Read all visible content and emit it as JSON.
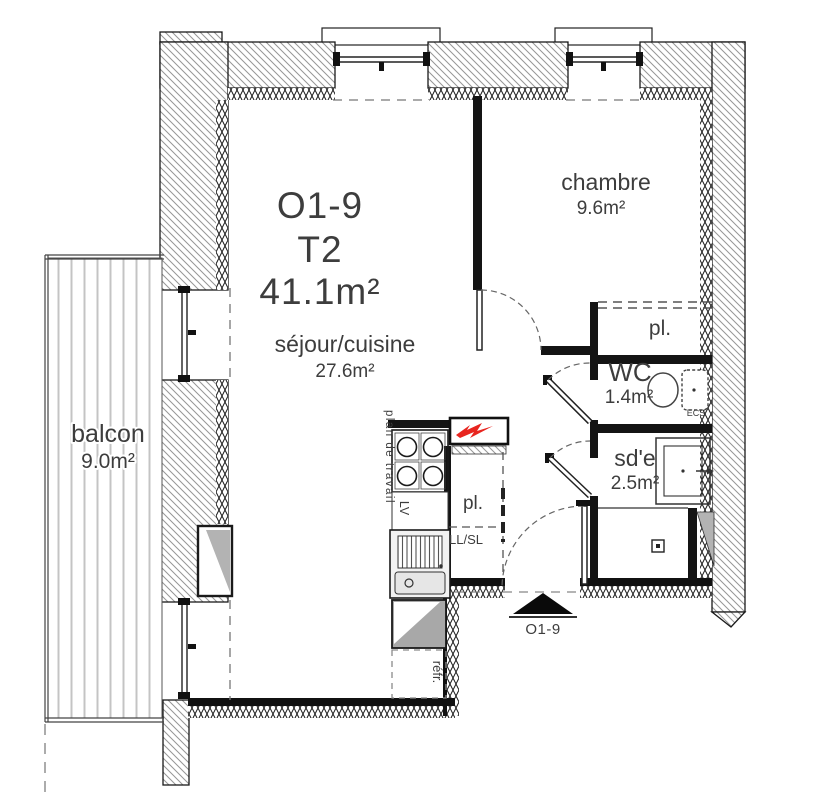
{
  "unit": {
    "id": "O1-9",
    "type": "T2",
    "area": "41.1m²"
  },
  "rooms": {
    "sejour": {
      "name": "séjour/cuisine",
      "area": "27.6m²"
    },
    "chambre": {
      "name": "chambre",
      "area": "9.6m²"
    },
    "balcon": {
      "name": "balcon",
      "area": "9.0m²"
    },
    "wc": {
      "name": "WC",
      "area": "1.4m²"
    },
    "sde": {
      "name": "sd'e",
      "area": "2.5m²"
    }
  },
  "closets": {
    "hall": "pl.",
    "kitchen": "pl."
  },
  "kitchen": {
    "worktop": "plan de travail",
    "dishwasher": "LV",
    "washer": "LL/SL",
    "fridge": "réfr."
  },
  "tech": {
    "ecs": "ECS"
  },
  "entry": {
    "label": "O1-9"
  },
  "colors": {
    "line": "#1a1a1a",
    "hatch": "#969696",
    "accent_red": "#e8251f",
    "gray_fill": "#b3b3b3",
    "text": "#3d3d3d"
  }
}
